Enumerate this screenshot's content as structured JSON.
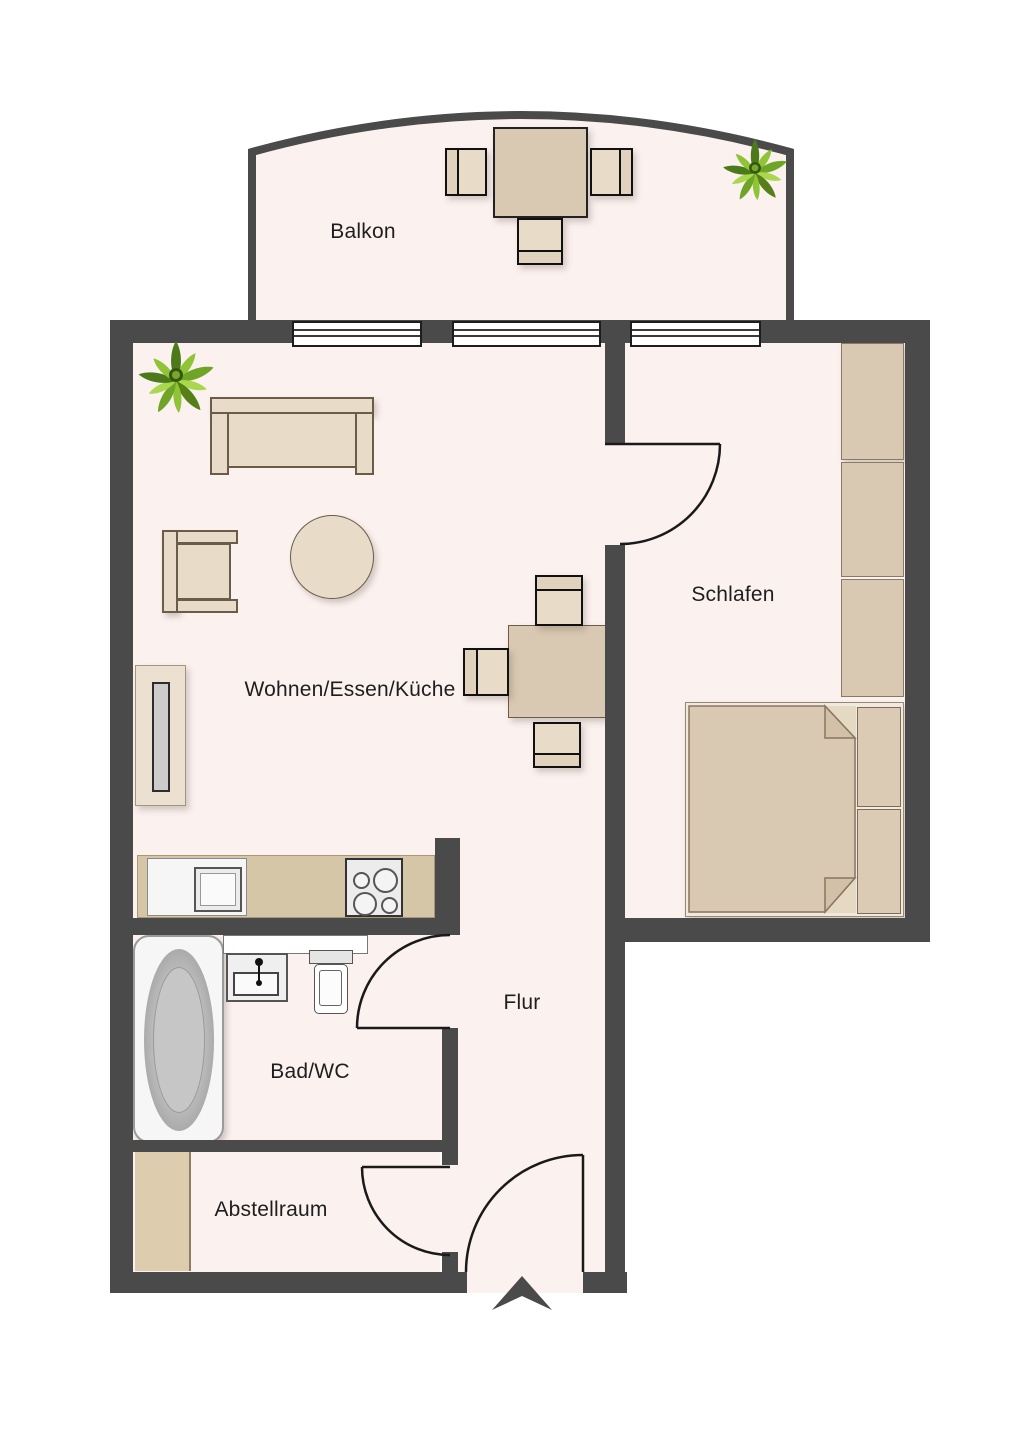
{
  "floorplan": {
    "type": "apartment-floor-plan",
    "rooms": [
      {
        "id": "balkon",
        "label": "Balkon"
      },
      {
        "id": "wohnen-essen-kueche",
        "label": "Wohnen/Essen/Küche"
      },
      {
        "id": "schlafen",
        "label": "Schlafen"
      },
      {
        "id": "flur",
        "label": "Flur"
      },
      {
        "id": "bad-wc",
        "label": "Bad/WC"
      },
      {
        "id": "abstellraum",
        "label": "Abstellraum"
      }
    ],
    "windows": {
      "count": 3,
      "wall": "top"
    },
    "doors": [
      {
        "id": "bedroom-door",
        "between": "Wohnen/Essen/Küche",
        "and": "Schlafen"
      },
      {
        "id": "bathroom-door",
        "between": "Flur",
        "and": "Bad/WC"
      },
      {
        "id": "storage-door",
        "between": "Flur",
        "and": "Abstellraum"
      },
      {
        "id": "entry-door",
        "between": "outside",
        "and": "Flur"
      }
    ],
    "entry_marker": {
      "shape": "arrow-chevron",
      "direction": "up"
    },
    "furniture": [
      {
        "name": "outdoor-table",
        "room": "Balkon"
      },
      {
        "name": "outdoor-chairs",
        "room": "Balkon",
        "count": 3
      },
      {
        "name": "potted-plant",
        "room": "Balkon"
      },
      {
        "name": "potted-plant",
        "room": "Wohnen/Essen/Küche"
      },
      {
        "name": "sofa",
        "room": "Wohnen/Essen/Küche"
      },
      {
        "name": "armchair",
        "room": "Wohnen/Essen/Küche"
      },
      {
        "name": "round-coffee-table",
        "room": "Wohnen/Essen/Küche"
      },
      {
        "name": "sideboard",
        "room": "Wohnen/Essen/Küche"
      },
      {
        "name": "dining-table",
        "room": "Wohnen/Essen/Küche"
      },
      {
        "name": "dining-chairs",
        "room": "Wohnen/Essen/Küche",
        "count": 3
      },
      {
        "name": "kitchen-counter",
        "room": "Wohnen/Essen/Küche"
      },
      {
        "name": "kitchen-sink",
        "room": "Wohnen/Essen/Küche"
      },
      {
        "name": "stove",
        "room": "Wohnen/Essen/Küche",
        "burners": 4
      },
      {
        "name": "wardrobe",
        "room": "Schlafen",
        "segments": 3
      },
      {
        "name": "double-bed",
        "room": "Schlafen",
        "pillows": 2
      },
      {
        "name": "bathtub",
        "room": "Bad/WC"
      },
      {
        "name": "washbasin",
        "room": "Bad/WC"
      },
      {
        "name": "toilet",
        "room": "Bad/WC"
      },
      {
        "name": "shelf",
        "room": "Abstellraum"
      }
    ],
    "colors": {
      "wall": "#4a4a4a",
      "floor": "#fbf1ef",
      "furniture_light": "#e8dcc9",
      "furniture_tan": "#d9c9b2",
      "plant_green": "#6fa527",
      "fixture_gray": "#b5b5b5",
      "outline": "#1a1a1a"
    }
  }
}
